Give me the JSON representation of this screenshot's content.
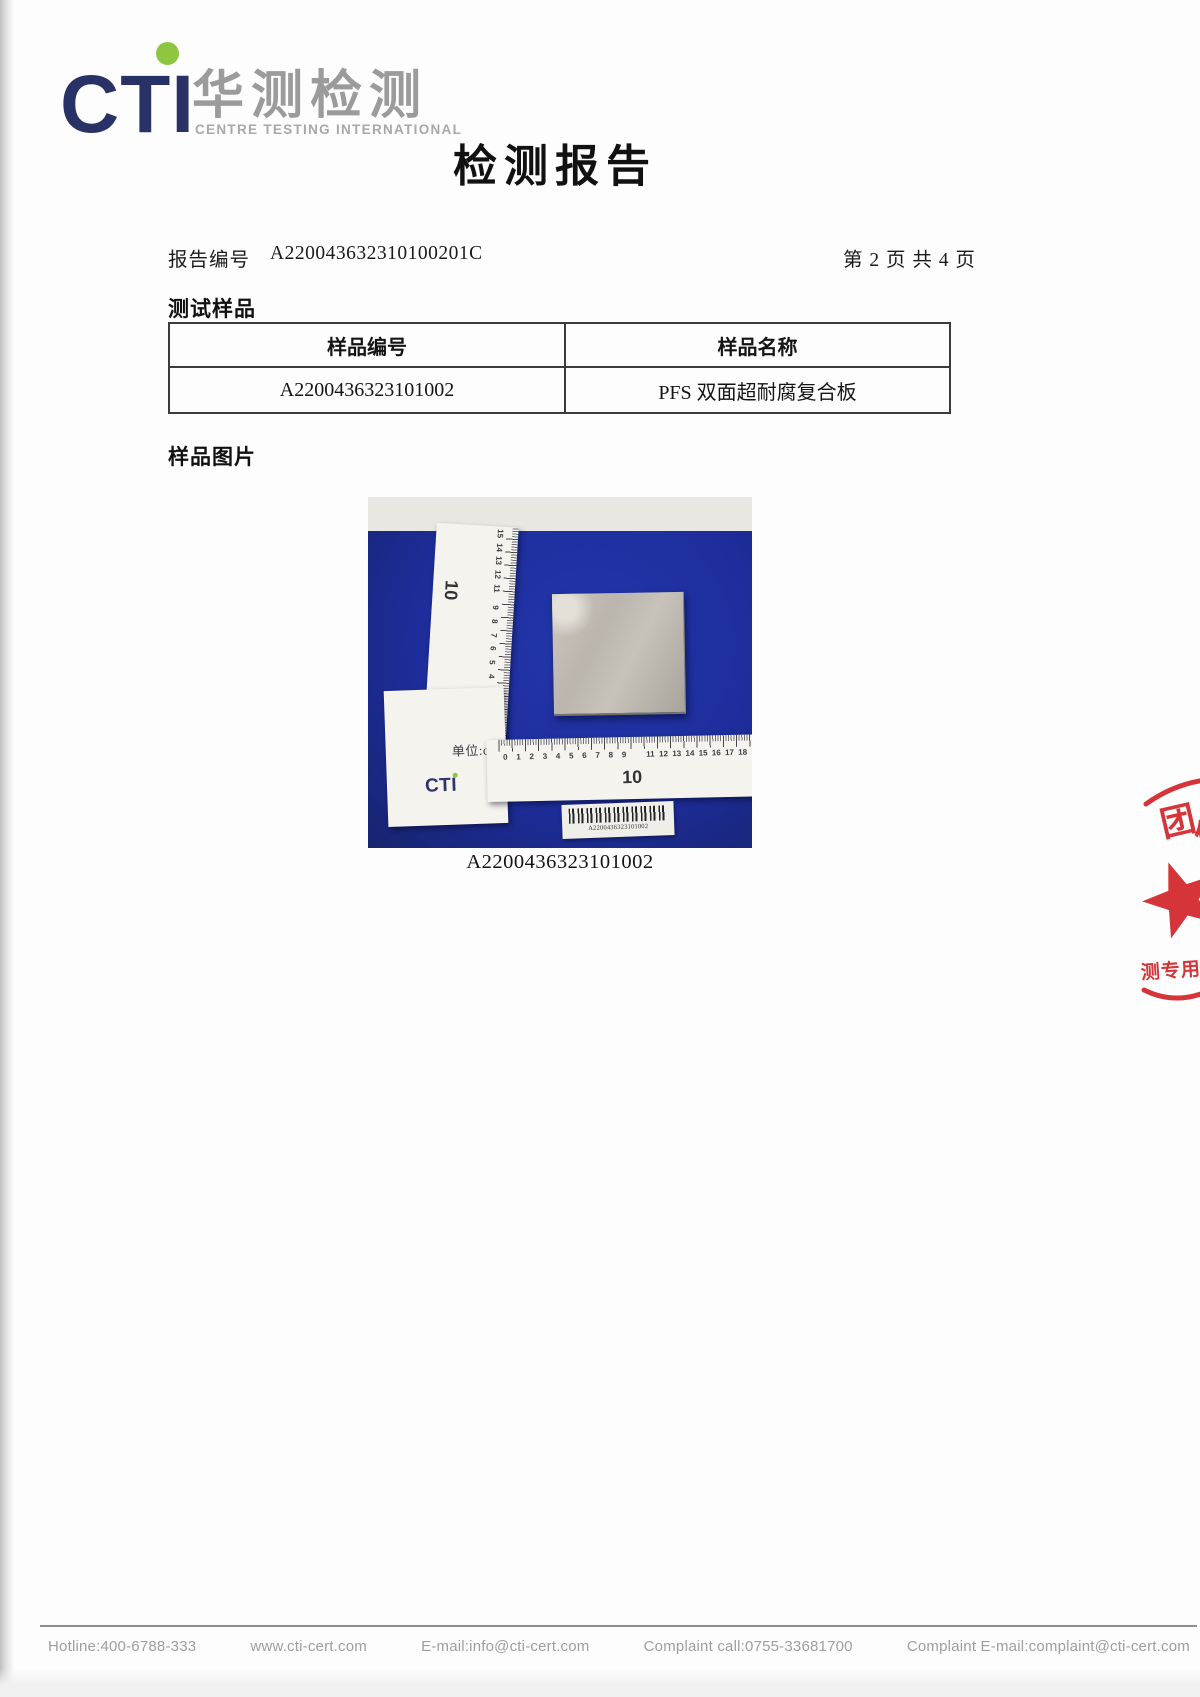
{
  "logo": {
    "letters": "CTI",
    "chinese": "华测检测",
    "subtitle": "CENTRE TESTING INTERNATIONAL"
  },
  "title": "检测报告",
  "report": {
    "number_label": "报告编号",
    "number": "A220043632310100201C",
    "page_info": "第 2 页 共 4 页"
  },
  "test_sample": {
    "heading": "测试样品",
    "table": {
      "headers": [
        "样品编号",
        "样品名称"
      ],
      "rows": [
        [
          "A2200436323101002",
          "PFS 双面超耐腐复合板"
        ]
      ]
    }
  },
  "sample_photo": {
    "heading": "样品图片",
    "caption": "A2200436323101002",
    "unit_label": "单位:cm",
    "ruler_brand": "CTI",
    "h_numbers": [
      "0",
      "1",
      "2",
      "3",
      "4",
      "5",
      "6",
      "7",
      "8",
      "9",
      "",
      "11",
      "12",
      "13",
      "14",
      "15",
      "16",
      "17",
      "18",
      "19"
    ],
    "h_big_left": "10",
    "h_big_right": "20",
    "v_numbers": [
      "15",
      "14",
      "13",
      "12",
      "11",
      "",
      "9",
      "8",
      "7",
      "6",
      "5",
      "4",
      "3",
      "2",
      "1",
      "0"
    ],
    "v_big": "10",
    "barcode_text": "A2200436323101002"
  },
  "stamp": {
    "top_char": "团",
    "partial_char": "体",
    "bottom_text": "测专用",
    "color": "#d2262b"
  },
  "footer": {
    "items": [
      "Hotline:400-6788-333",
      "www.cti-cert.com",
      "E-mail:info@cti-cert.com",
      "Complaint call:0755-33681700",
      "Complaint E-mail:complaint@cti-cert.com"
    ]
  },
  "colors": {
    "logo_navy": "#293266",
    "logo_green": "#8dc63f",
    "photo_blue": "#1d2d9b",
    "stamp_red": "#d2262b"
  }
}
